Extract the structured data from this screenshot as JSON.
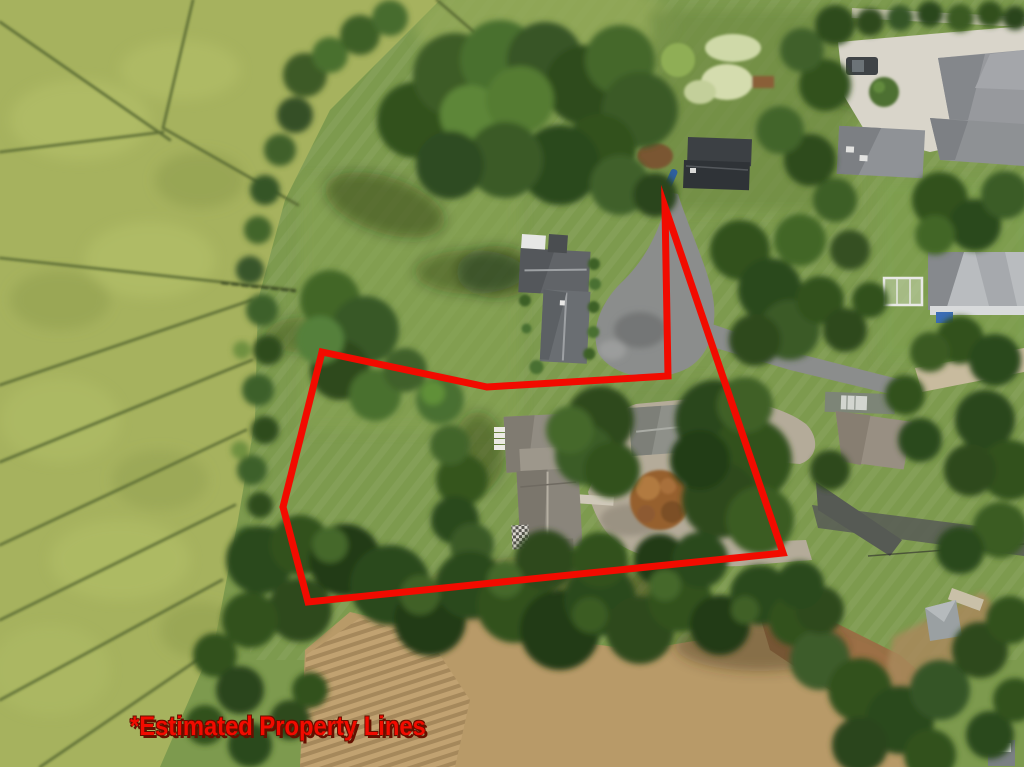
{
  "annotation": {
    "label": "*Estimated Property Lines",
    "color": "#f20b00",
    "shadow_color": "#641000",
    "polygon_points": "322,352 487,387 668,376 665,207 783,553 308,602 283,507",
    "stroke_width_px": 7
  },
  "palette": {
    "marsh": "#a6b25e",
    "marsh_channel": "#556630",
    "lawn": "#7d9a4e",
    "lawn_light": "#8da657",
    "neighbor_lawn": "#6f8b44",
    "tree_dark": "#2c481c",
    "tree_mid": "#3c5e26",
    "tree_light": "#548033",
    "dirt": "#b89a68",
    "dirt_light": "#c6a97a",
    "mulch": "#9a6e44",
    "asphalt": "#8b8d8c",
    "gravel": "#b4ab99",
    "concrete": "#d9d5ca",
    "roof_dark": "#616468",
    "roof_warm": "#948e82",
    "roof_light": "#b9bcbf",
    "road_dirt": "#c8bb9e",
    "autumn_tree": "#96602f"
  }
}
